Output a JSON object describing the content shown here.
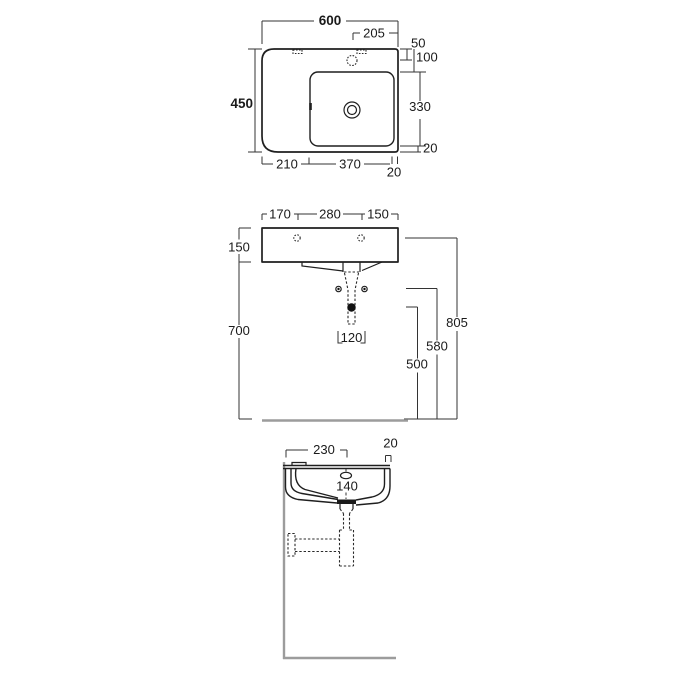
{
  "top_view": {
    "overall_width": "600",
    "overall_depth": "450",
    "tap_hole_from_right": "205",
    "tap_hole_from_back": "50",
    "bowl_from_back": "100",
    "bowl_front_to_back": "330",
    "bowl_to_front_edge": "20",
    "ledge_width": "210",
    "bowl_width": "370",
    "bowl_to_right_edge": "20"
  },
  "front_view": {
    "left_to_fixing": "170",
    "fixing_spacing": "280",
    "fixing_to_right": "150",
    "basin_height": "150",
    "underside_to_floor": "700",
    "fixing_holes_to_floor": "805",
    "bolts_to_floor": "580",
    "outlet_to_floor": "500",
    "bolt_spacing": "120"
  },
  "side_view": {
    "wall_to_drain": "230",
    "front_rim_width": "20",
    "bowl_inner_depth": "140"
  }
}
